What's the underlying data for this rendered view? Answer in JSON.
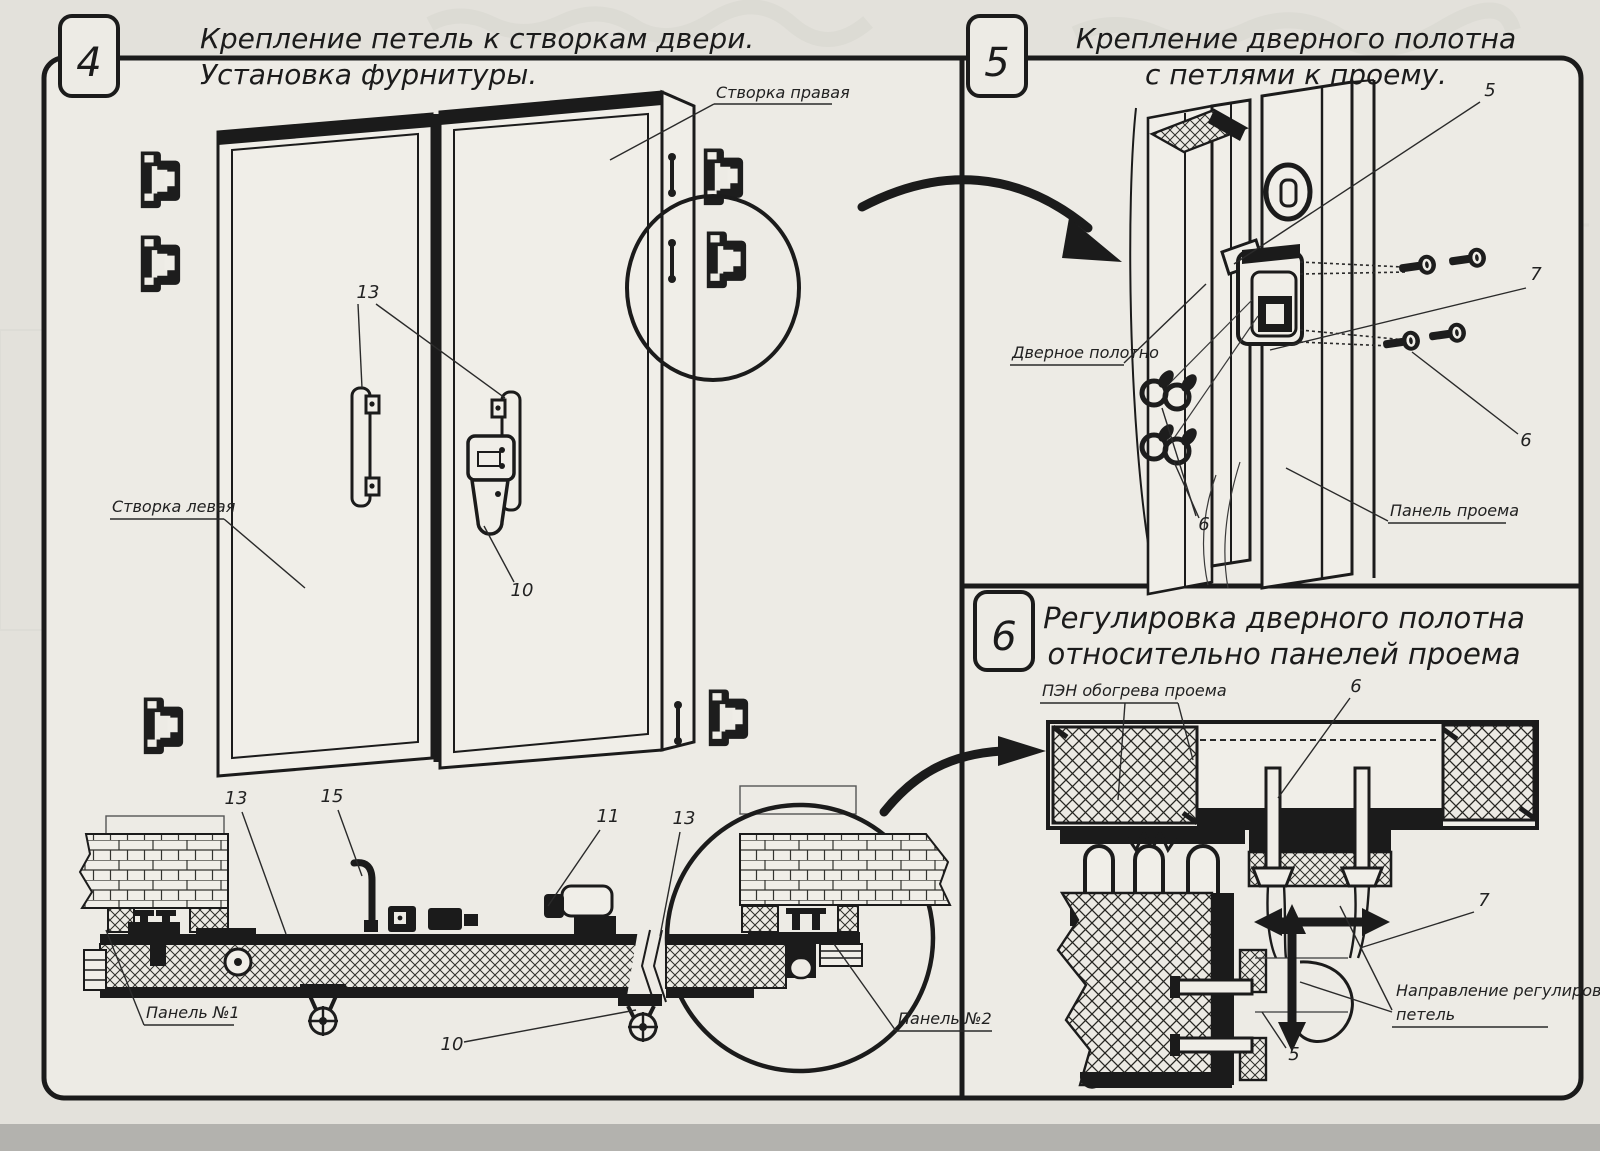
{
  "colors": {
    "paper_outer": "#e3e1db",
    "paper_inner": "#edebe5",
    "ink": "#1b1b1b",
    "ghost": "#cfd0c8",
    "scanner_strip": "#b3b2ae"
  },
  "panel4": {
    "number": "4",
    "title1": "Крепление петель к створкам двери.",
    "title2": "Установка фурнитуры.",
    "label_right_leaf": "Створка правая",
    "label_left_leaf": "Створка левая",
    "label_panel1": "Панель №1",
    "label_panel2": "Панель №2",
    "callout_handles": "13",
    "callout_latch": "10",
    "callout_section13": "13",
    "callout_bracket15": "15",
    "callout_lock11": "11",
    "callout_section13b": "13",
    "callout_support10": "10"
  },
  "panel5": {
    "number": "5",
    "title1": "Крепление дверного полотна",
    "title2": "с петлями к проему.",
    "label_door_leaf": "Дверное полотно",
    "label_opening_panel": "Панель проема",
    "callout_5": "5",
    "callout_7": "7",
    "callout_6_right": "6",
    "callout_6_left": "6"
  },
  "panel6": {
    "number": "6",
    "title1": "Регулировка дверного полотна",
    "title2": "относительно панелей проема",
    "label_heater": "ПЭН обогрева проема",
    "label_direction1": "Направление регулировки",
    "label_direction2": "петель",
    "callout_6": "6",
    "callout_7": "7",
    "callout_5": "5"
  }
}
